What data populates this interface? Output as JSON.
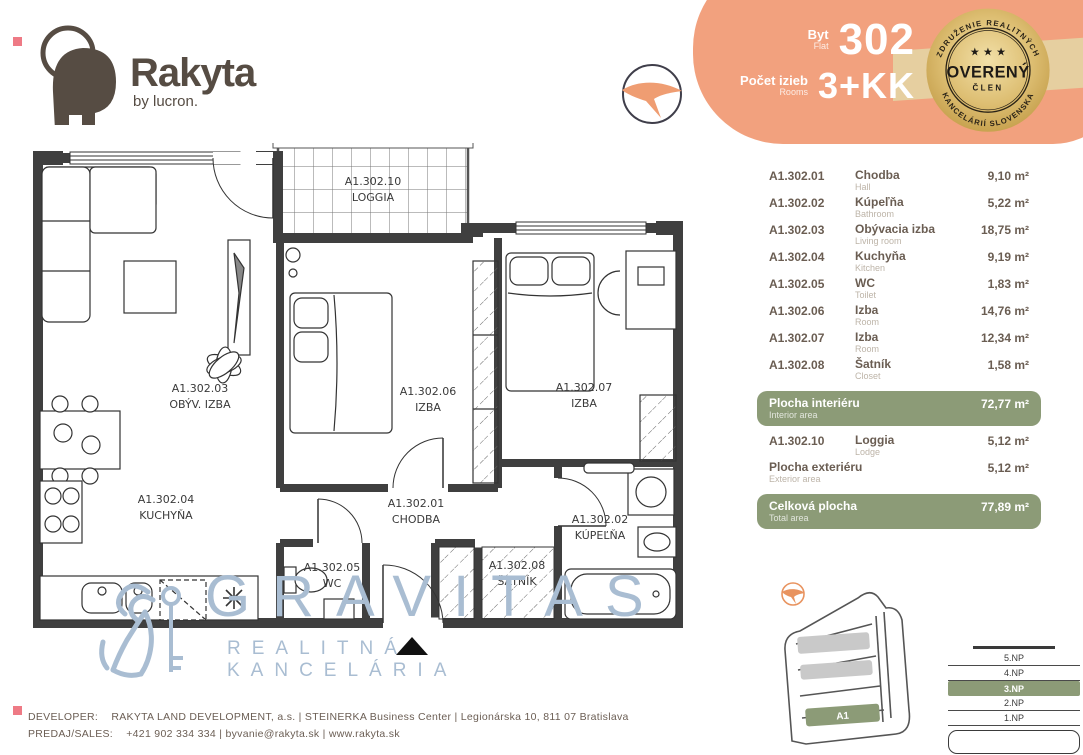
{
  "brand": {
    "name": "Rakyta",
    "byline": "by lucron."
  },
  "header": {
    "flat_label": "Byt",
    "flat_label_en": "Flat",
    "flat_number": "302",
    "rooms_label": "Počet izieb",
    "rooms_label_en": "Rooms",
    "rooms_value": "3+KK"
  },
  "badge": {
    "arc_top": "ZDRUŽENIE REALITNÝCH",
    "arc_bottom": "KANCELÁRIÍ SLOVENSKA",
    "stars": "★ ★ ★",
    "center": "OVERENÝ",
    "member": "ČLEN"
  },
  "floorplan": {
    "rooms": [
      {
        "code": "A1.302.10",
        "name": "LOGGIA"
      },
      {
        "code": "A1.302.03",
        "name": "OBÝV. IZBA"
      },
      {
        "code": "A1.302.06",
        "name": "IZBA"
      },
      {
        "code": "A1.302.07",
        "name": "IZBA"
      },
      {
        "code": "A1.302.04",
        "name": "KUCHYŇA"
      },
      {
        "code": "A1.302.01",
        "name": "CHODBA"
      },
      {
        "code": "A1.302.05",
        "name": "WC"
      },
      {
        "code": "A1.302.08",
        "name": "ŠATNÍK"
      },
      {
        "code": "A1.302.02",
        "name": "KÚPEĽŇA"
      }
    ]
  },
  "watermark": {
    "title": "GRAVITAS",
    "subtitle": "REALITNÁ KANCELÁRIA"
  },
  "areas": {
    "rows": [
      {
        "code": "A1.302.01",
        "name": "Chodba",
        "name_en": "Hall",
        "value": "9,10 m²"
      },
      {
        "code": "A1.302.02",
        "name": "Kúpeľňa",
        "name_en": "Bathroom",
        "value": "5,22 m²"
      },
      {
        "code": "A1.302.03",
        "name": "Obývacia izba",
        "name_en": "Living room",
        "value": "18,75 m²"
      },
      {
        "code": "A1.302.04",
        "name": "Kuchyňa",
        "name_en": "Kitchen",
        "value": "9,19 m²"
      },
      {
        "code": "A1.302.05",
        "name": "WC",
        "name_en": "Toilet",
        "value": "1,83 m²"
      },
      {
        "code": "A1.302.06",
        "name": "Izba",
        "name_en": "Room",
        "value": "14,76 m²"
      },
      {
        "code": "A1.302.07",
        "name": "Izba",
        "name_en": "Room",
        "value": "12,34 m²"
      },
      {
        "code": "A1.302.08",
        "name": "Šatník",
        "name_en": "Closet",
        "value": "1,58 m²"
      }
    ],
    "interior": {
      "label": "Plocha interiéru",
      "label_en": "Interior area",
      "value": "72,77 m²"
    },
    "loggia": {
      "code": "A1.302.10",
      "name": "Loggia",
      "name_en": "Lodge",
      "value": "5,12 m²"
    },
    "exterior": {
      "label": "Plocha exteriéru",
      "label_en": "Exterior area",
      "value": "5,12 m²"
    },
    "total": {
      "label": "Celková plocha",
      "label_en": "Total area",
      "value": "77,89 m²"
    }
  },
  "site": {
    "block_label": "A1",
    "floors": [
      "5.NP",
      "4.NP",
      "3.NP",
      "2.NP",
      "1.NP"
    ],
    "active_floor": "3.NP"
  },
  "footer": {
    "line1_label": "DEVELOPER:",
    "line1": "RAKYTA LAND DEVELOPMENT, a.s.   |   STEINERKA Business Center   |   Legionárska 10, 811 07  Bratislava",
    "line2_label": "PREDAJ/SALES:",
    "line2": "+421 902 334 334   |   byvanie@rakyta.sk   |   www.rakyta.sk"
  },
  "colors": {
    "salmon": "#F2A17E",
    "green": "#8C9B77",
    "brown": "#564C43",
    "gold": "#D4AF5E",
    "watermark_blue": "#A9BDD2",
    "wall": "#3F3F3F"
  }
}
